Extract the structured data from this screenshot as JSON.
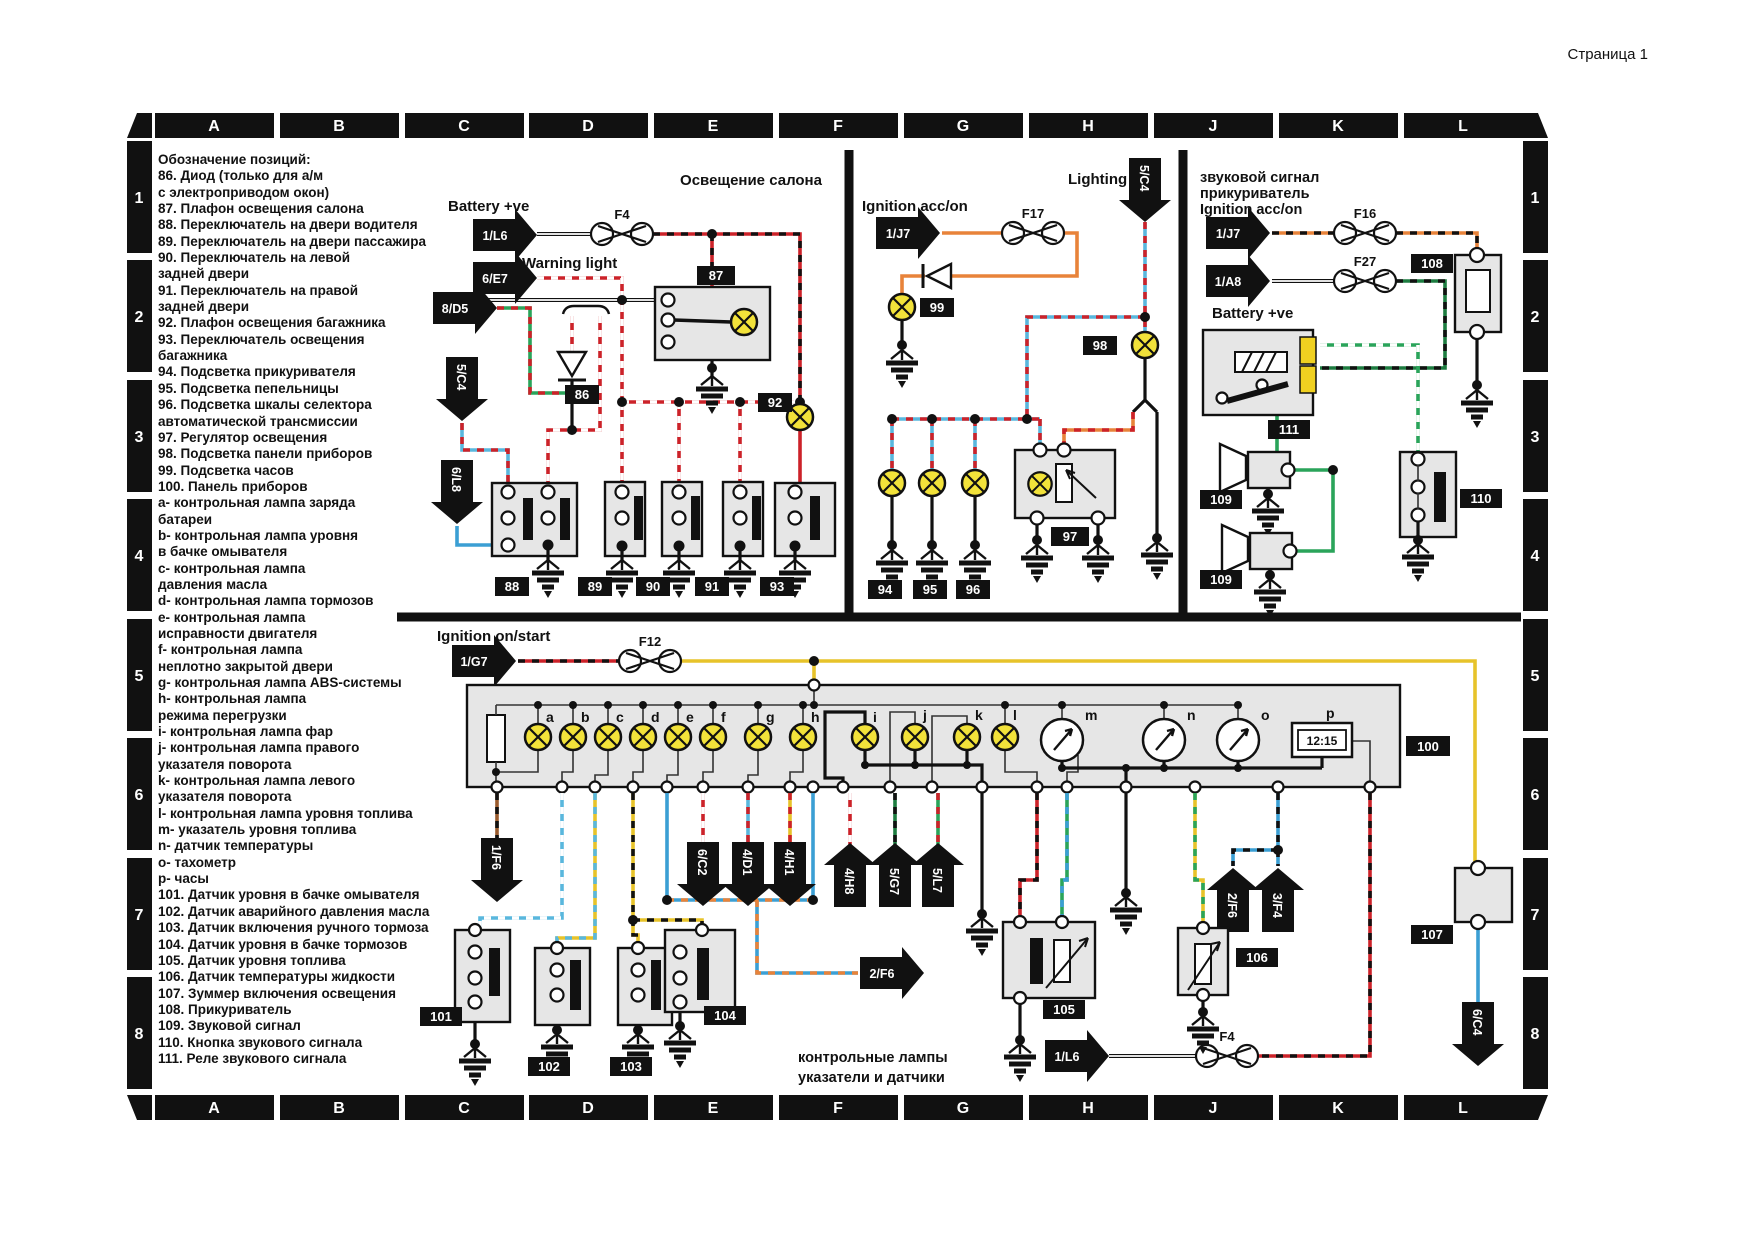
{
  "page": {
    "corner": "Страница 1"
  },
  "grid": {
    "cols": [
      "A",
      "B",
      "C",
      "D",
      "E",
      "F",
      "G",
      "H",
      "J",
      "K",
      "L"
    ],
    "rows": [
      "1",
      "2",
      "3",
      "4",
      "5",
      "6",
      "7",
      "8"
    ]
  },
  "legend": {
    "lines": [
      "Обозначение позиций:",
      "86. Диод (только для а/м",
      "с электроприводом окон)",
      "87. Плафон освещения салона",
      "88. Переключатель на двери водителя",
      "89. Переключатель на двери пассажира",
      "90. Переключатель на левой",
      "задней двери",
      "91. Переключатель на правой",
      "задней двери",
      "92. Плафон освещения багажника",
      "93. Переключатель освещения",
      "багажника",
      "94. Подсветка прикуривателя",
      "95. Подсветка пепельницы",
      "96. Подсветка шкалы селектора",
      "автоматической трансмиссии",
      "97. Регулятор освещения",
      "98. Подсветка панели приборов",
      "99. Подсветка часов",
      "100. Панель приборов",
      "a- контрольная лампа заряда",
      "батареи",
      "b- контрольная лампа уровня",
      "в бачке омывателя",
      "c- контрольная лампа",
      "давления масла",
      "d- контрольная лампа тормозов",
      "e- контрольная лампа",
      "исправности двигателя",
      "f- контрольная лампа",
      "неплотно закрытой двери",
      "g- контрольная лампа ABS-системы",
      "h- контрольная лампа",
      "режима перегрузки",
      "i- контрольная лампа фар",
      "j- контрольная лампа правого",
      "указателя поворота",
      "k- контрольная лампа левого",
      "указателя поворота",
      "l- контрольная лампа уровня топлива",
      "m- указатель уровня топлива",
      "n- датчик температуры",
      "o- тахометр",
      "p- часы",
      "101. Датчик уровня в бачке омывателя",
      "102. Датчик аварийного давления масла",
      "103. Датчик включения ручного тормоза",
      "104. Датчик уровня в бачке тормозов",
      "105. Датчик уровня топлива",
      "106. Датчик температуры жидкости",
      "107. Зуммер включения освещения",
      "108. Прикуриватель",
      "109. Звуковой сигнал",
      "110. Кнопка звукового сигнала",
      "111. Реле звукового сигнала"
    ]
  },
  "titles": {
    "interior": "Освещение салона",
    "lighting": "Lighting",
    "horn_line1": "звуковой сигнал",
    "horn_line2": "прикуриватель",
    "horn_line3": "Ignition acc/on",
    "ignition_acc": "Ignition acc/on",
    "ignition_on": "Ignition on/start",
    "battery_left": "Battery +ve",
    "battery_right": "Battery +ve",
    "warning": "Warning light",
    "caption_line1": "контрольные лампы",
    "caption_line2": "указатели и датчики"
  },
  "fuses": {
    "f4_top": "F4",
    "f17": "F17",
    "f16": "F16",
    "f27": "F27",
    "f12": "F12",
    "f4_bottom": "F4"
  },
  "refs": {
    "l6_top": "1/L6",
    "e7": "6/E7",
    "d5": "8/D5",
    "c4_left": "5/C4",
    "l8": "6/L8",
    "j7_mid": "1/J7",
    "c4_light": "5/C4",
    "j7_right": "1/J7",
    "a8": "1/A8",
    "g7": "1/G7",
    "f6_down": "1/F6",
    "c2": "6/C2",
    "d1": "4/D1",
    "h1": "4/H1",
    "h8": "4/H8",
    "g7_up": "5/G7",
    "l7": "5/L7",
    "f6_right": "2/F6",
    "f6_up": "2/F6",
    "f4_up": "3/F4",
    "l6_bottom": "1/L6",
    "c4_bottom": "6/C4"
  },
  "nums": {
    "n86": "86",
    "n87": "87",
    "n88": "88",
    "n89": "89",
    "n90": "90",
    "n91": "91",
    "n92": "92",
    "n93": "93",
    "n94": "94",
    "n95": "95",
    "n96": "96",
    "n97": "97",
    "n98": "98",
    "n99": "99",
    "n100": "100",
    "n101": "101",
    "n102": "102",
    "n103": "103",
    "n104": "104",
    "n105": "105",
    "n106": "106",
    "n107": "107",
    "n108": "108",
    "n109a": "109",
    "n109b": "109",
    "n110": "110",
    "n111": "111"
  },
  "panel": {
    "letters": [
      "a",
      "b",
      "c",
      "d",
      "e",
      "f",
      "g",
      "h",
      "i",
      "j",
      "k",
      "l",
      "m",
      "n",
      "o",
      "p"
    ],
    "clock": "12:15"
  }
}
